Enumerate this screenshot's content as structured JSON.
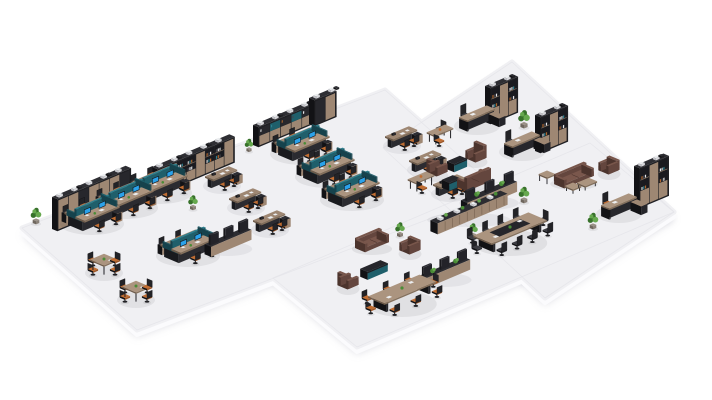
{
  "scene": {
    "description": "Isometric 3D render of an open-plan office layout with workstation clusters, executive desks with bookcases, lounge sofas, meeting tables and plants on pale floating floor slabs",
    "canvas": {
      "width": 712,
      "height": 400
    },
    "background": "#ffffff",
    "palette": {
      "floor_top": "#f0f0f3",
      "floor_side": "#fbfbfd",
      "floor_line": "#e4e4e9",
      "floor_shadow": "#bfbfca",
      "dark": "#202024",
      "darker": "#121215",
      "dark_top": "#2e2e33",
      "dark_face": "#27272c",
      "chair_back": "#232327",
      "wood": "#9e8773",
      "wood_lt": "#ab947f",
      "wood_dk": "#84705c",
      "wood_edge": "#6e5b4a",
      "teal": "#1f5f6b",
      "teal_lt": "#2e7f8e",
      "teal_dk": "#16424c",
      "blue": "#2ba2ea",
      "seat_orange": "#c06d32",
      "seat_orange_dk": "#9a5526",
      "seat_dark": "#3b3b41",
      "seat_dark_dk": "#2c2c31",
      "sofa": "#64463e",
      "sofa_lt": "#78564b",
      "sofa_dk": "#4c342d",
      "green": "#4a8c36",
      "green_dk": "#37712a",
      "green_lt": "#66a84e",
      "pot": "#8a8178",
      "item_white": "#eceef0"
    },
    "floor_slabs": [
      {
        "points": [
          [
            383,
            148
          ],
          [
            512,
            62
          ],
          [
            674,
            212
          ],
          [
            545,
            298
          ]
        ]
      },
      {
        "points": [
          [
            22,
            228
          ],
          [
            385,
            90
          ],
          [
            500,
            192
          ],
          [
            137,
            330
          ]
        ]
      },
      {
        "points": [
          [
            273,
            278
          ],
          [
            590,
            143
          ],
          [
            674,
            212
          ],
          [
            357,
            347
          ]
        ]
      }
    ],
    "objects": [
      {
        "t": "plant",
        "x": 146,
        "y": 197,
        "s": 0.9
      },
      {
        "t": "shelf",
        "x": 152,
        "y": 193,
        "len": 84,
        "h": 26,
        "style": "book"
      },
      {
        "t": "plant",
        "x": 249,
        "y": 151,
        "s": 0.8
      },
      {
        "t": "shelf",
        "x": 253,
        "y": 145,
        "len": 60,
        "h": 20,
        "style": "mixed"
      },
      {
        "t": "shelf",
        "x": 309,
        "y": 124,
        "len": 24,
        "h": 26,
        "style": "dark"
      },
      {
        "t": "plant",
        "x": 36,
        "y": 223,
        "s": 1.0
      },
      {
        "t": "shelf",
        "x": 52,
        "y": 229,
        "len": 80,
        "h": 32,
        "style": "wood"
      },
      {
        "t": "shelf",
        "x": 485,
        "y": 122,
        "len": 30,
        "h": 36,
        "style": "book"
      },
      {
        "t": "edesk",
        "x": 477,
        "y": 124,
        "chair": "dark"
      },
      {
        "t": "sdesk",
        "x": 440,
        "y": 140,
        "chairs": [
          [
            9,
            -8,
            "sw",
            "dark"
          ],
          [
            -8,
            7,
            "ne",
            "orange"
          ]
        ]
      },
      {
        "t": "plant",
        "x": 524,
        "y": 127,
        "s": 1.1
      },
      {
        "t": "shelf",
        "x": 535,
        "y": 151,
        "len": 30,
        "h": 36,
        "style": "book"
      },
      {
        "t": "edesk",
        "x": 522,
        "y": 150,
        "chair": "dark"
      },
      {
        "t": "shelf",
        "x": 634,
        "y": 206,
        "len": 32,
        "h": 40,
        "style": "book"
      },
      {
        "t": "edesk",
        "x": 619,
        "y": 212,
        "chair": "orange"
      },
      {
        "t": "plant",
        "x": 593,
        "y": 228,
        "s": 1.0
      },
      {
        "t": "ws",
        "x": 160,
        "y": 190
      },
      {
        "t": "ws",
        "x": 126,
        "y": 205
      },
      {
        "t": "ws",
        "x": 92,
        "y": 221
      },
      {
        "t": "ws",
        "x": 302,
        "y": 151
      },
      {
        "t": "ws",
        "x": 327,
        "y": 174
      },
      {
        "t": "ws",
        "x": 352,
        "y": 197
      },
      {
        "t": "bench",
        "x": 402,
        "y": 144
      },
      {
        "t": "bench",
        "x": 426,
        "y": 168
      },
      {
        "t": "bench",
        "x": 450,
        "y": 192
      },
      {
        "t": "bench",
        "x": 222,
        "y": 184
      },
      {
        "t": "bench",
        "x": 246,
        "y": 206
      },
      {
        "t": "bench",
        "x": 270,
        "y": 228
      },
      {
        "t": "plant",
        "x": 193,
        "y": 209,
        "s": 0.9
      },
      {
        "t": "ws",
        "x": 188,
        "y": 253,
        "bright": true
      },
      {
        "t": "divider",
        "x": 228,
        "y": 247,
        "len": 44
      },
      {
        "t": "sq4",
        "x": 104,
        "y": 270
      },
      {
        "t": "sq4",
        "x": 136,
        "y": 297
      },
      {
        "t": "sofa",
        "x": 476,
        "y": 159,
        "len": 12,
        "back": "ne",
        "hb": true
      },
      {
        "t": "media",
        "x": 457,
        "y": 168,
        "len": 14
      },
      {
        "t": "sofa",
        "x": 437,
        "y": 173,
        "len": 12,
        "back": "sw",
        "hb": true
      },
      {
        "t": "media",
        "x": 451,
        "y": 187,
        "len": 12
      },
      {
        "t": "sofa",
        "x": 474,
        "y": 185,
        "len": 26,
        "back": "se",
        "hb": true
      },
      {
        "t": "sdesk",
        "x": 421,
        "y": 187,
        "chairs": [
          [
            -7,
            8,
            "ne",
            "orange"
          ]
        ]
      },
      {
        "t": "divider",
        "x": 489,
        "y": 201,
        "len": 54,
        "plants": true
      },
      {
        "t": "plant",
        "x": 524,
        "y": 202,
        "s": 1.0
      },
      {
        "t": "stable",
        "x": 547,
        "y": 181
      },
      {
        "t": "sofa",
        "x": 574,
        "y": 181,
        "len": 32,
        "back": "nw"
      },
      {
        "t": "sofa",
        "x": 609,
        "y": 171,
        "len": 12,
        "back": "ne"
      },
      {
        "t": "ctable",
        "x": 573,
        "y": 191,
        "len": 9
      },
      {
        "t": "ctable",
        "x": 587,
        "y": 187,
        "len": 13
      },
      {
        "t": "lowcab",
        "x": 469,
        "y": 218,
        "len": 76
      },
      {
        "t": "plant",
        "x": 473,
        "y": 237,
        "s": 0.9
      },
      {
        "t": "conf",
        "x": 510,
        "y": 239,
        "len": 60,
        "w": 20,
        "dark_center": true,
        "side": 4,
        "ends": true,
        "seat": "dark",
        "hb": true
      },
      {
        "t": "plant",
        "x": 400,
        "y": 236,
        "s": 0.9
      },
      {
        "t": "sofa",
        "x": 372,
        "y": 246,
        "len": 26,
        "back": "nw"
      },
      {
        "t": "sofa",
        "x": 410,
        "y": 251,
        "len": 12,
        "back": "ne"
      },
      {
        "t": "media",
        "x": 374,
        "y": 274,
        "len": 22
      },
      {
        "t": "sofa",
        "x": 348,
        "y": 286,
        "len": 12,
        "back": "sw",
        "hb": true
      },
      {
        "t": "divider",
        "x": 444,
        "y": 278,
        "len": 50,
        "plants": true
      },
      {
        "t": "conf",
        "x": 402,
        "y": 300,
        "len": 56,
        "w": 18,
        "side": 3,
        "ends": true,
        "seat": "orange"
      }
    ]
  }
}
